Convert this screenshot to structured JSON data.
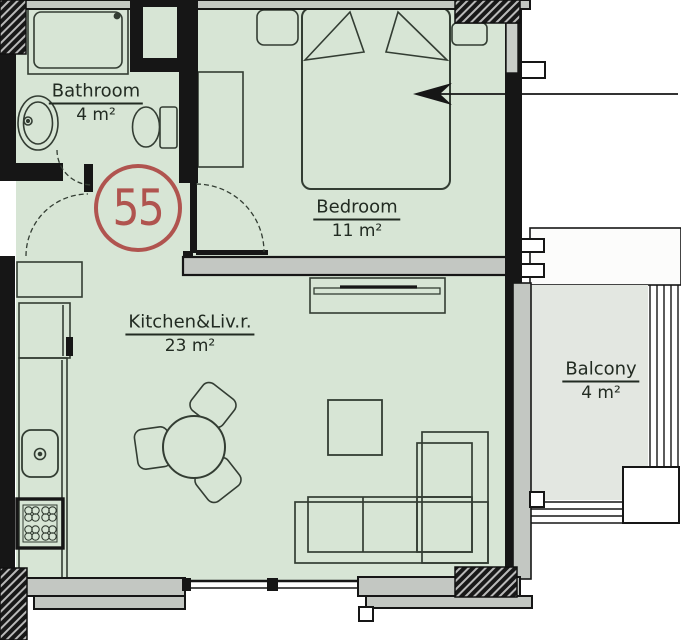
{
  "unit": {
    "number": "55"
  },
  "rooms": {
    "bathroom": {
      "name": "Bathroom",
      "area": "4 m²"
    },
    "bedroom": {
      "name": "Bedroom",
      "area": "11 m²"
    },
    "kitchen_living": {
      "name": "Kitchen&Liv.r.",
      "area": "23 m²"
    },
    "balcony": {
      "name": "Balcony",
      "area": "4 m²"
    }
  },
  "colors": {
    "interior_fill": "#d7e5d5",
    "balcony_floor": "#e3e7e1",
    "wall": "#161616",
    "wall_core": "#c3c7c2",
    "accent_red": "#b0544f",
    "text": "#222b22"
  }
}
